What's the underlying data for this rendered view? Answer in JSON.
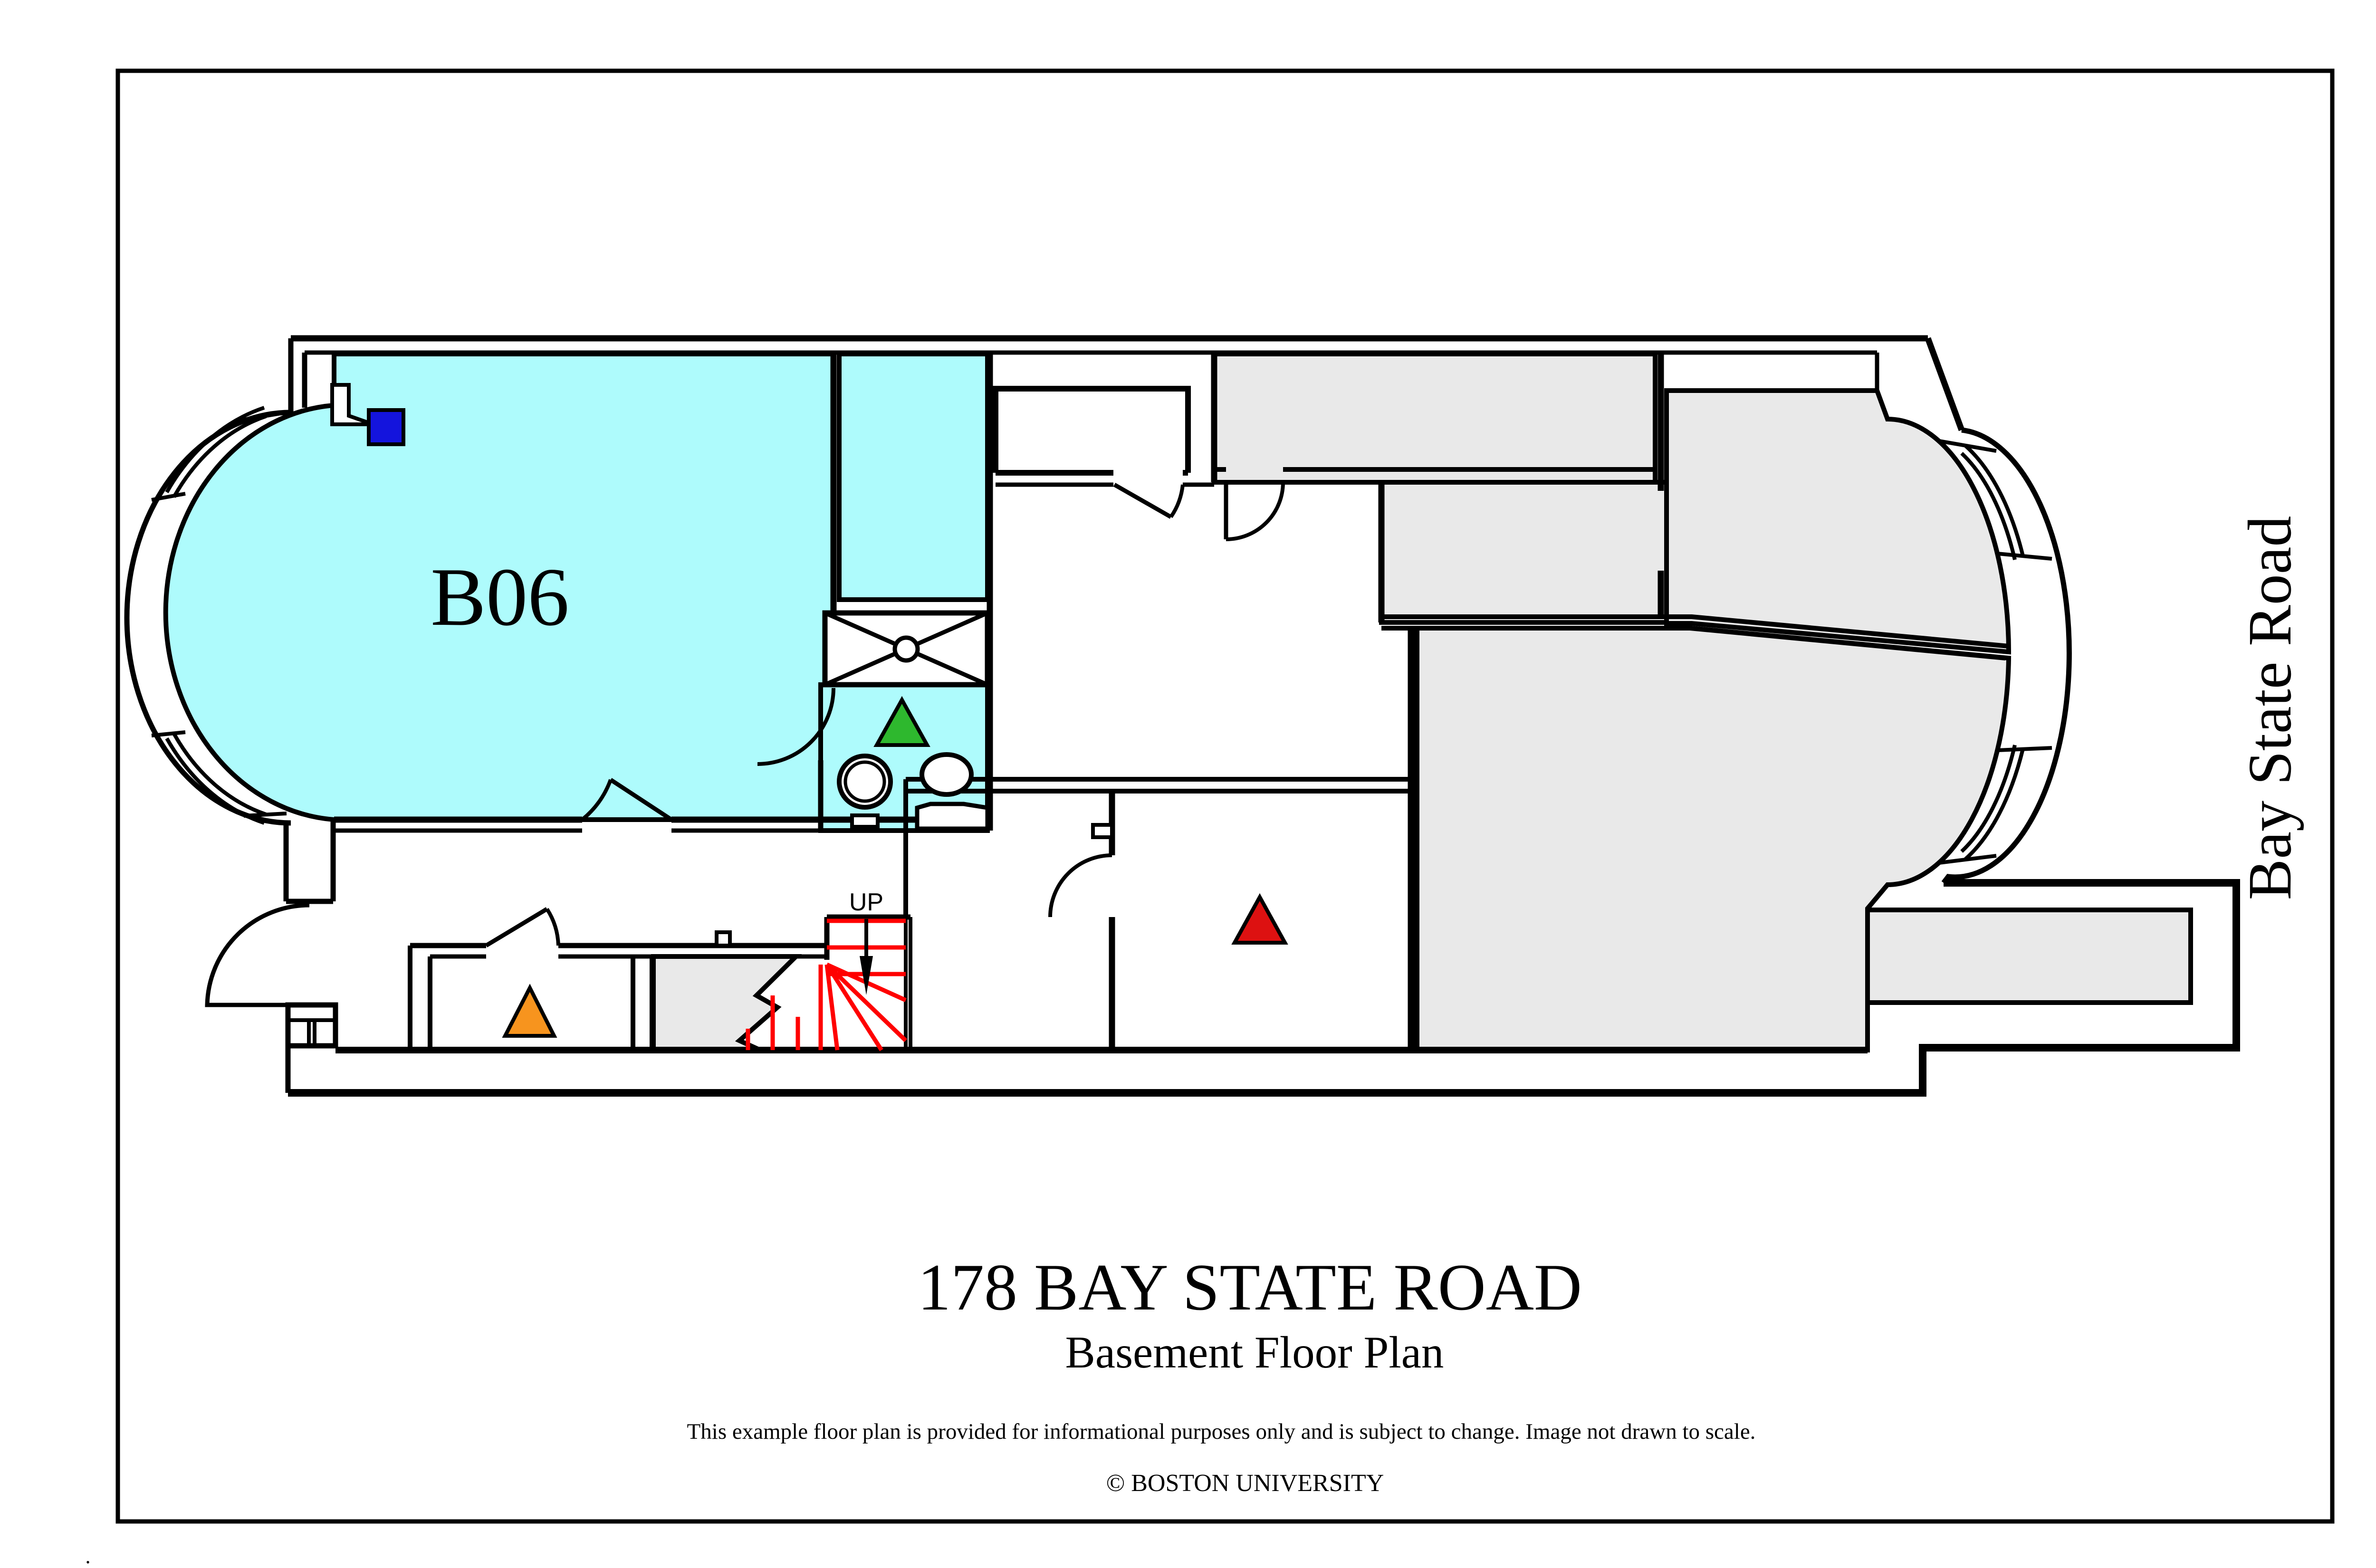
{
  "plan": {
    "room_label": "B06",
    "stairs_label": "UP",
    "street_label": "Bay State Road"
  },
  "footer": {
    "title": "178 BAY STATE ROAD",
    "subtitle": "Basement Floor Plan",
    "disclaimer": "This example floor plan is provided for informational purposes only and is subject to change. Image not drawn to scale.",
    "copyright": "© BOSTON UNIVERSITY",
    "stray_mark": "."
  },
  "colors": {
    "highlight_room": "#aefbfc",
    "common_area": "#e9e9e9",
    "wall": "#000000",
    "stair_tread": "#ff0000",
    "markers": {
      "blue_square": "#1414dd",
      "green_triangle": "#2eb82e",
      "orange_triangle": "#f7941e",
      "red_triangle": "#dd1111"
    }
  }
}
